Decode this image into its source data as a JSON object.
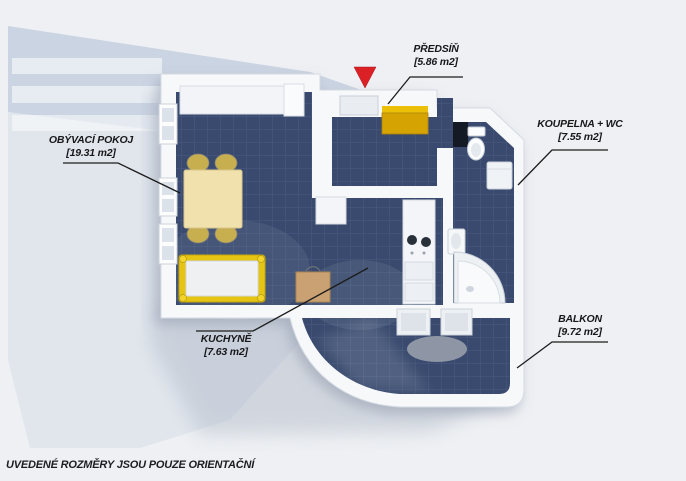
{
  "page": {
    "background": "#eef0f3"
  },
  "disclaimer": "UVEDENÉ ROZMĚRY JSOU POUZE ORIENTAČNÍ",
  "rooms": [
    {
      "name": "PŘEDSÍŇ",
      "area": "[5.86 m2]"
    },
    {
      "name": "OBÝVACÍ POKOJ",
      "area": "[19.31 m2]"
    },
    {
      "name": "KOUPELNA + WC",
      "area": "[7.55 m2]"
    },
    {
      "name": "KUCHYNĚ",
      "area": "[7.63 m2]"
    },
    {
      "name": "BALKON",
      "area": "[9.72 m2]"
    }
  ],
  "entrance_marker": {
    "type": "red-triangle-arrow",
    "color": "#dc2126"
  },
  "colors": {
    "floor_tile": "#394a6e",
    "tile_grout": "#4a5b81",
    "walls": "#f7f8fa",
    "background_shape": "#cbd4e2",
    "accent_yellow": "#d6a402",
    "bed_frame_yellow": "#e5c413",
    "table_cream": "#f1e2ad",
    "label_text": "#18181a"
  }
}
